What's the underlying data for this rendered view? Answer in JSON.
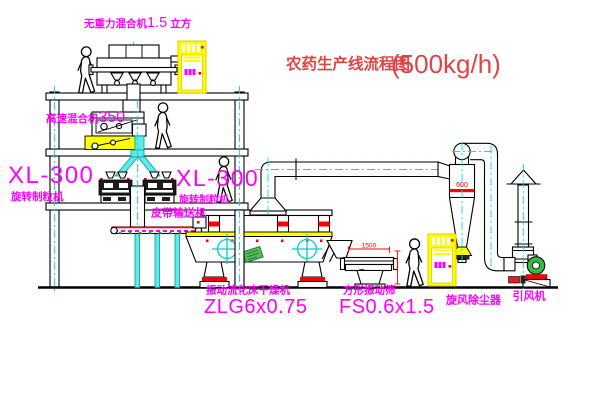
{
  "title": {
    "text": "农药生产线流程图",
    "capacity": "(500kg/h)"
  },
  "labels": {
    "weightless_mixer": {
      "name": "无重力混合机",
      "size": "1.5",
      "unit": "立方"
    },
    "high_speed_mixer": {
      "name": "高速混合机",
      "model": "350"
    },
    "granulator_left": {
      "model": "XL-300",
      "name": "旋转制粒机"
    },
    "granulator_right": {
      "model": "XL-300",
      "name": "旋转制粒机"
    },
    "belt_conveyor": {
      "name": "皮带输送机"
    },
    "dryer": {
      "name": "振动流化床干燥机",
      "model": "ZLG6x0.75"
    },
    "screen": {
      "name": "方形振动筛",
      "model": "FS0.6x1.5"
    },
    "cyclone": {
      "name": "旋风除尘器"
    },
    "fan": {
      "name": "引风机"
    }
  },
  "dimensions": {
    "screen_length": "1500",
    "cyclone_diameter": "600"
  },
  "colors": {
    "label_magenta": "#ff00ff",
    "title_red": "#e04545",
    "dimension_red": "#ff0000",
    "centerline_cyan": "#00dede",
    "highlight_yellow": "#ffff00",
    "nameplate_green": "#5cb85c",
    "line_black": "#000000"
  }
}
